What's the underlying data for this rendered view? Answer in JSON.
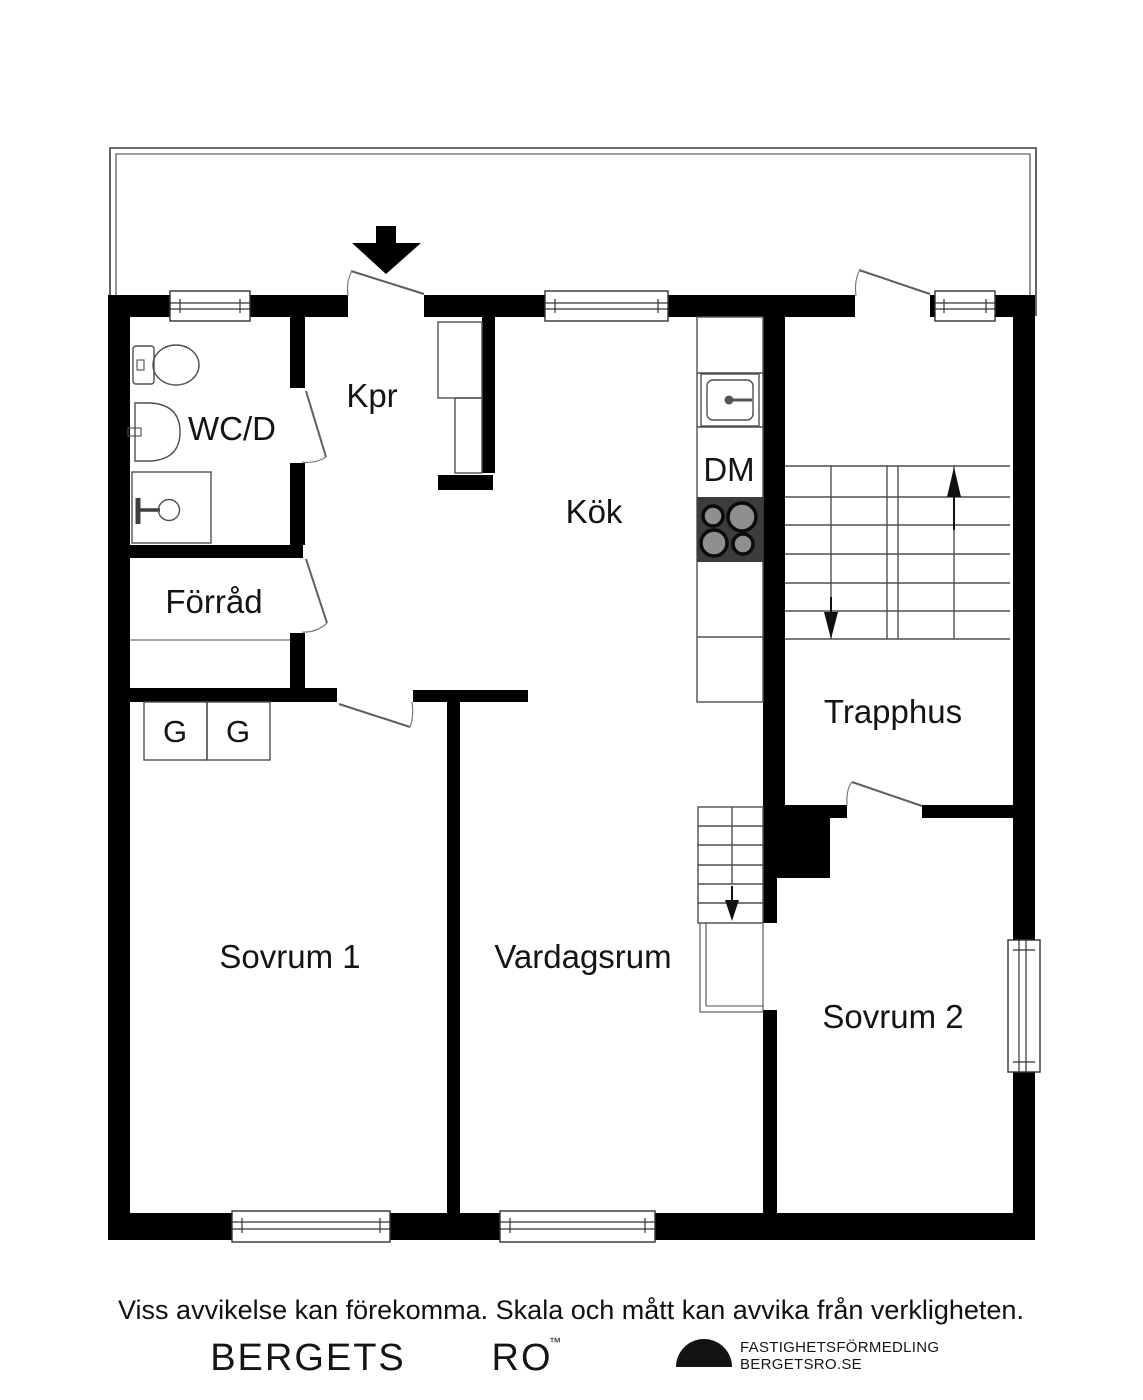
{
  "plan": {
    "labels": {
      "wcd": "WC/D",
      "kpr": "Kpr",
      "kok": "Kök",
      "dm": "DM",
      "forrad": "Förråd",
      "g_left": "G",
      "g_right": "G",
      "sovrum1": "Sovrum 1",
      "vardagsrum": "Vardagsrum",
      "trapphus": "Trapphus",
      "sovrum2": "Sovrum 2"
    }
  },
  "footer": {
    "disclaimer": "Viss avvikelse kan förekomma. Skala och mått kan avvika från verkligheten.",
    "brand_word1": "BERGETS",
    "brand_word2": "RO",
    "trademark": "™",
    "agency_line1": "FASTIGHETSFÖRMEDLING",
    "agency_line2": "BERGETSRO.SE"
  },
  "colors": {
    "wall": "#000000",
    "thin_line": "#4f4f4f",
    "door_line": "#6a6a6a",
    "stove": "#3c3c3c",
    "burner": "#8f8f8f",
    "text": "#141414",
    "background": "#ffffff"
  }
}
